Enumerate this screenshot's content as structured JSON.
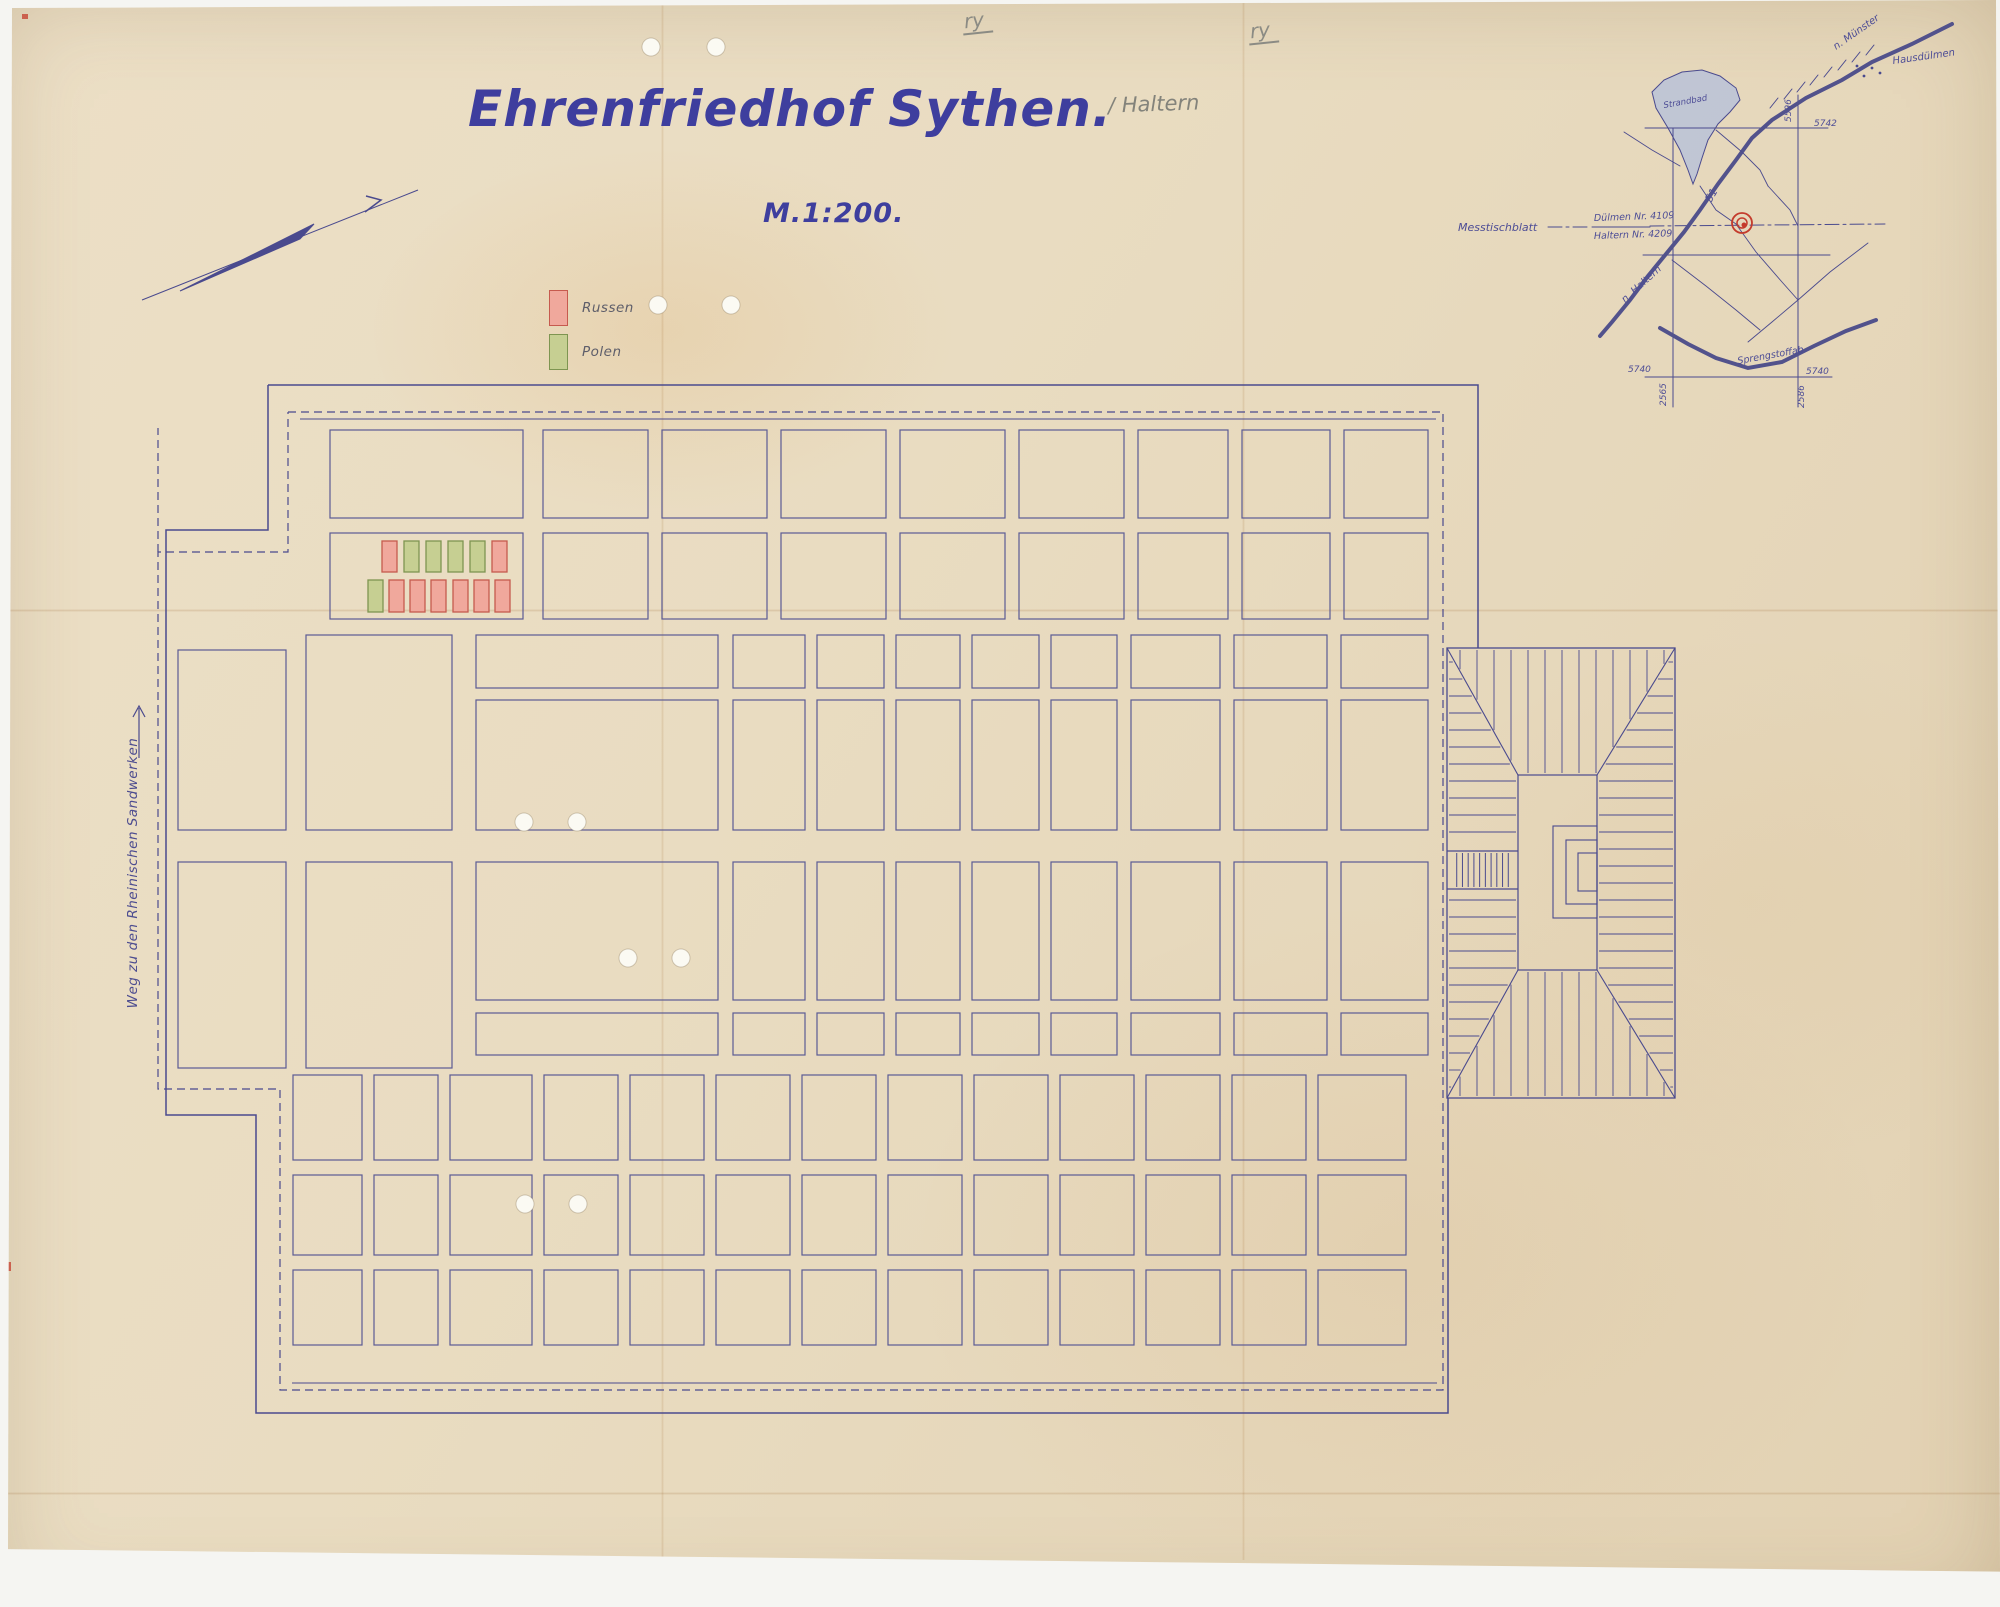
{
  "document": {
    "title": "Ehrenfriedhof Sythen.",
    "title_annotation": "/ Haltern",
    "scale_label": "M.1:200.",
    "pencil_marks": [
      "ry",
      "ry"
    ]
  },
  "legend": {
    "items": [
      {
        "label": "Russen",
        "fill": "#f0a89c",
        "stroke": "#c65a4e"
      },
      {
        "label": "Polen",
        "fill": "#c6cf92",
        "stroke": "#7e9551"
      }
    ]
  },
  "west_road": {
    "label": "Weg zu den Rheinischen Sandwerken"
  },
  "colors": {
    "ink": "#4a4a8e",
    "plot_line": "#5b5b94",
    "pencil": "#8b8b84",
    "red_annotation": "#c43b2c",
    "lake_fill": "#b9c2d8",
    "hole_fill": "#fbfaf3"
  },
  "plan": {
    "boundary": {
      "solid": [
        "M268,385 H1478 V648",
        "M268,385 V530 H166 V1115 H256 V1413 H1448 V1098"
      ],
      "inner_solid": [
        "M300,419 H1436",
        "M292,1383 H1437"
      ],
      "dashed": [
        "M288,412 H1443 V1390 H280 V1089 H158 V552 H288 V412",
        "M158,552 V428"
      ]
    },
    "col_sets": {
      "a": [
        [
          330,
          193
        ],
        [
          543,
          105
        ],
        [
          662,
          105
        ],
        [
          781,
          105
        ],
        [
          900,
          105
        ],
        [
          1019,
          105
        ],
        [
          1138,
          90
        ],
        [
          1242,
          88
        ],
        [
          1344,
          84
        ]
      ],
      "b": [
        [
          476,
          242
        ],
        [
          733,
          72
        ],
        [
          817,
          67
        ],
        [
          896,
          64
        ],
        [
          972,
          67
        ],
        [
          1051,
          66
        ],
        [
          1131,
          89
        ],
        [
          1234,
          93
        ],
        [
          1341,
          87
        ]
      ],
      "d": [
        [
          293,
          69
        ],
        [
          374,
          64
        ],
        [
          450,
          82
        ],
        [
          544,
          74
        ],
        [
          630,
          74
        ],
        [
          716,
          74
        ],
        [
          802,
          74
        ],
        [
          888,
          74
        ],
        [
          974,
          74
        ],
        [
          1060,
          74
        ],
        [
          1146,
          74
        ],
        [
          1232,
          74
        ],
        [
          1318,
          88
        ]
      ]
    },
    "plot_rows": [
      {
        "y": 430,
        "h": 88,
        "cols": "a"
      },
      {
        "y": 533,
        "h": 86,
        "cols": "a"
      },
      {
        "y": 635,
        "h": 53,
        "cols": "b"
      },
      {
        "y": 700,
        "h": 130,
        "cols": "b"
      },
      {
        "y": 862,
        "h": 138,
        "cols": "b"
      },
      {
        "y": 1013,
        "h": 42,
        "cols": "b"
      },
      {
        "y": 1075,
        "h": 85,
        "cols": "d"
      },
      {
        "y": 1175,
        "h": 80,
        "cols": "d"
      },
      {
        "y": 1270,
        "h": 75,
        "cols": "d"
      }
    ],
    "extra_plots": [
      [
        178,
        650,
        108,
        180
      ],
      [
        306,
        635,
        146,
        195
      ],
      [
        178,
        862,
        108,
        206
      ],
      [
        306,
        862,
        146,
        206
      ]
    ],
    "grave_rows": [
      {
        "y": 541,
        "h": 31,
        "w": 15,
        "items": [
          [
            382,
            "R"
          ],
          [
            404,
            "P"
          ],
          [
            426,
            "P"
          ],
          [
            448,
            "P"
          ],
          [
            470,
            "P"
          ],
          [
            492,
            "R"
          ]
        ]
      },
      {
        "y": 580,
        "h": 32,
        "w": 15,
        "items": [
          [
            368,
            "P"
          ],
          [
            389,
            "R"
          ],
          [
            410,
            "R"
          ],
          [
            431,
            "R"
          ],
          [
            453,
            "R"
          ],
          [
            474,
            "R"
          ],
          [
            495,
            "R"
          ]
        ]
      }
    ],
    "memorial": {
      "outer": {
        "x": 1447,
        "y": 648,
        "w": 228,
        "h": 450
      },
      "court": {
        "x": 1518,
        "y": 775,
        "w": 79,
        "h": 195
      },
      "spacing": 17,
      "steps": {
        "y1": 851,
        "y2": 889,
        "treads": 10
      },
      "monument": [
        [
          1553,
          826,
          44,
          92
        ],
        [
          1566,
          840,
          31,
          64
        ],
        [
          1578,
          853,
          19,
          38
        ]
      ]
    },
    "north_arrow": {
      "line": [
        142,
        300,
        418,
        190
      ],
      "needle": "180,291 314,224 300,239",
      "tick": "365,212 381,200 366,196"
    },
    "weg_arrow": {
      "line": [
        139,
        758,
        139,
        708
      ],
      "head": "133,717 139,706 145,717"
    },
    "holes": [
      [
        651,
        47
      ],
      [
        716,
        47
      ],
      [
        658,
        305
      ],
      [
        731,
        305
      ],
      [
        524,
        822
      ],
      [
        577,
        822
      ],
      [
        628,
        958
      ],
      [
        681,
        958
      ],
      [
        525,
        1204
      ],
      [
        578,
        1204
      ]
    ],
    "red_marks": [
      [
        6,
        62,
        3,
        14
      ],
      [
        6,
        88,
        3,
        10
      ],
      [
        5,
        210,
        4,
        8
      ],
      [
        5,
        545,
        4,
        10
      ],
      [
        8,
        1262,
        3,
        9
      ],
      [
        22,
        14,
        6,
        5
      ]
    ]
  },
  "minimap": {
    "lake": "1652,92 1664,80 1682,72 1702,70 1720,76 1736,88 1740,100 1730,112 1718,124 1708,140 1702,158 1697,174 1693,184 1688,170 1680,150 1668,128 1656,108",
    "lines": [
      {
        "pts": [
          [
            1673,
            128
          ],
          [
            1673,
            407
          ]
        ],
        "w": 1
      },
      {
        "pts": [
          [
            1798,
            95
          ],
          [
            1798,
            407
          ]
        ],
        "w": 1
      },
      {
        "pts": [
          [
            1645,
            128
          ],
          [
            1828,
            128
          ]
        ],
        "w": 1
      },
      {
        "pts": [
          [
            1643,
            255
          ],
          [
            1830,
            255
          ]
        ],
        "w": 1
      },
      {
        "pts": [
          [
            1645,
            377
          ],
          [
            1832,
            377
          ]
        ],
        "w": 1
      },
      {
        "pts": [
          [
            1592,
            227
          ],
          [
            1650,
            227
          ]
        ],
        "w": 1
      },
      {
        "pts": [
          [
            1548,
            227
          ],
          [
            1590,
            227
          ]
        ],
        "w": 1,
        "dash": "14 4 3 4"
      },
      {
        "pts": [
          [
            1650,
            226
          ],
          [
            1885,
            224
          ]
        ],
        "w": 1,
        "dash": "14 4 3 4"
      },
      {
        "pts": [
          [
            1952,
            24
          ],
          [
            1912,
            44
          ],
          [
            1872,
            62
          ],
          [
            1842,
            80
          ],
          [
            1806,
            98
          ],
          [
            1772,
            120
          ],
          [
            1752,
            138
          ],
          [
            1736,
            160
          ],
          [
            1718,
            184
          ],
          [
            1700,
            210
          ],
          [
            1684,
            232
          ],
          [
            1666,
            254
          ],
          [
            1648,
            276
          ],
          [
            1630,
            300
          ],
          [
            1612,
            322
          ],
          [
            1600,
            336
          ]
        ],
        "w": 4
      },
      {
        "pts": [
          [
            1660,
            328
          ],
          [
            1688,
            344
          ],
          [
            1716,
            358
          ],
          [
            1748,
            368
          ],
          [
            1782,
            362
          ],
          [
            1814,
            346
          ],
          [
            1846,
            331
          ],
          [
            1876,
            320
          ]
        ],
        "w": 4
      },
      {
        "pts": [
          [
            1770,
            108
          ],
          [
            1778,
            98
          ]
        ],
        "w": 1
      },
      {
        "pts": [
          [
            1784,
            99
          ],
          [
            1792,
            89
          ]
        ],
        "w": 1
      },
      {
        "pts": [
          [
            1797,
            92
          ],
          [
            1805,
            82
          ]
        ],
        "w": 1
      },
      {
        "pts": [
          [
            1810,
            85
          ],
          [
            1818,
            75
          ]
        ],
        "w": 1
      },
      {
        "pts": [
          [
            1824,
            77
          ],
          [
            1832,
            67
          ]
        ],
        "w": 1
      },
      {
        "pts": [
          [
            1838,
            70
          ],
          [
            1846,
            60
          ]
        ],
        "w": 1
      },
      {
        "pts": [
          [
            1852,
            62
          ],
          [
            1860,
            52
          ]
        ],
        "w": 1
      },
      {
        "pts": [
          [
            1866,
            55
          ],
          [
            1874,
            45
          ]
        ],
        "w": 1
      },
      {
        "pts": [
          [
            1700,
            186
          ],
          [
            1716,
            210
          ],
          [
            1736,
            224
          ]
        ],
        "w": 0.9
      },
      {
        "pts": [
          [
            1736,
            224
          ],
          [
            1756,
            252
          ],
          [
            1782,
            282
          ],
          [
            1798,
            300
          ]
        ],
        "w": 0.9
      },
      {
        "pts": [
          [
            1798,
            300
          ],
          [
            1830,
            272
          ],
          [
            1868,
            243
          ]
        ],
        "w": 0.9
      },
      {
        "pts": [
          [
            1798,
            300
          ],
          [
            1772,
            322
          ],
          [
            1748,
            342
          ]
        ],
        "w": 0.9
      },
      {
        "pts": [
          [
            1672,
            260
          ],
          [
            1706,
            286
          ],
          [
            1736,
            310
          ],
          [
            1760,
            330
          ]
        ],
        "w": 0.9
      },
      {
        "pts": [
          [
            1624,
            132
          ],
          [
            1652,
            150
          ],
          [
            1680,
            166
          ]
        ],
        "w": 0.9
      },
      {
        "pts": [
          [
            1716,
            130
          ],
          [
            1742,
            152
          ],
          [
            1760,
            170
          ],
          [
            1768,
            186
          ]
        ],
        "w": 0.9
      },
      {
        "pts": [
          [
            1768,
            186
          ],
          [
            1790,
            210
          ],
          [
            1798,
            226
          ]
        ],
        "w": 0.9
      }
    ],
    "red_circle": {
      "cx": 1742,
      "cy": 223,
      "r1": 10,
      "r2": 5
    },
    "labels": [
      {
        "text": "Hausdülmen",
        "x": 1893,
        "y": 64,
        "size": 10,
        "rot": -8
      },
      {
        "text": "n. Münster",
        "x": 1836,
        "y": 50,
        "size": 10,
        "rot": -35
      },
      {
        "text": "51",
        "x": 1711,
        "y": 203,
        "size": 11,
        "rot": -60
      },
      {
        "text": "n. Haltern",
        "x": 1625,
        "y": 303,
        "size": 10,
        "rot": -42
      },
      {
        "text": "Strandbad",
        "x": 1664,
        "y": 108,
        "size": 8.5,
        "rot": -10
      },
      {
        "text": "Sprengstoffab.",
        "x": 1738,
        "y": 364,
        "size": 9.5,
        "rot": -10
      },
      {
        "text": "Messtischblatt",
        "x": 1458,
        "y": 231,
        "size": 11,
        "rot": 0
      },
      {
        "text": "Dülmen Nr. 4109",
        "x": 1594,
        "y": 221,
        "size": 9.5,
        "rot": -2
      },
      {
        "text": "Haltern Nr. 4209",
        "x": 1594,
        "y": 239,
        "size": 9.5,
        "rot": -2
      },
      {
        "text": "5742",
        "x": 1814,
        "y": 126,
        "size": 9,
        "rot": 0
      },
      {
        "text": "5596",
        "x": 1791,
        "y": 122,
        "size": 9,
        "rot": -90
      },
      {
        "text": "5740",
        "x": 1628,
        "y": 372,
        "size": 9,
        "rot": 0
      },
      {
        "text": "5740",
        "x": 1806,
        "y": 374,
        "size": 9,
        "rot": 0
      },
      {
        "text": "2565",
        "x": 1666,
        "y": 406,
        "size": 9,
        "rot": -90
      },
      {
        "text": "2586",
        "x": 1804,
        "y": 408,
        "size": 9,
        "rot": -90
      }
    ]
  }
}
